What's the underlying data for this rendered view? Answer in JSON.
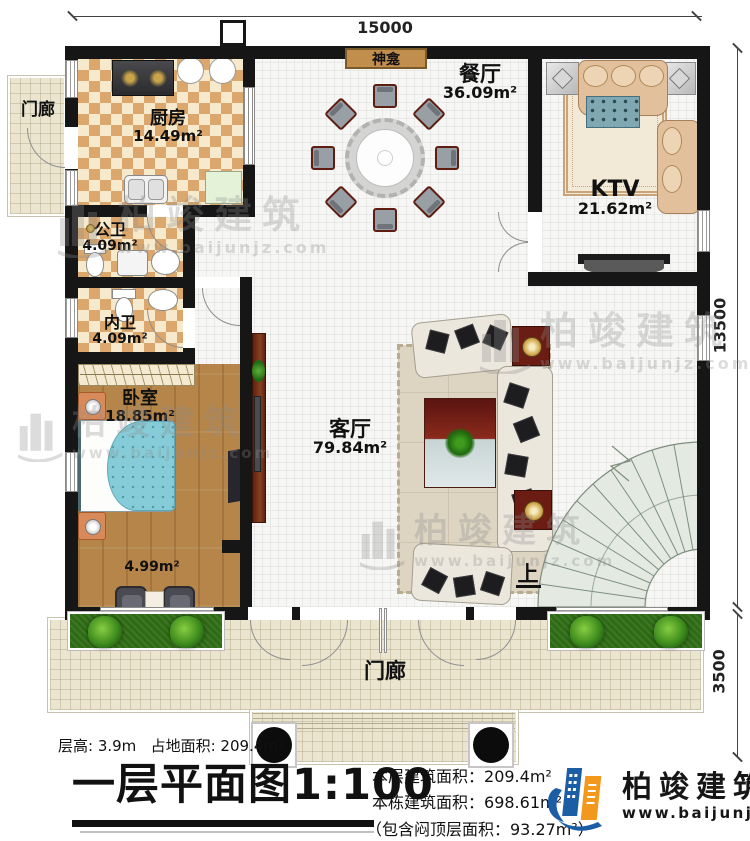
{
  "dim": {
    "top": "15000",
    "right": "13500",
    "bottom_right": "3500"
  },
  "rooms": {
    "porch_top": {
      "name": "门廊"
    },
    "kitchen": {
      "name": "厨房",
      "area": "14.49m²"
    },
    "public_bath": {
      "name": "公卫",
      "area": "4.09m²"
    },
    "private_bath": {
      "name": "内卫",
      "area": "4.09m²"
    },
    "bedroom": {
      "name": "卧室",
      "area": "18.85m²"
    },
    "alcove": {
      "area": "4.99m²"
    },
    "living": {
      "name": "客厅",
      "area": "79.84m²"
    },
    "dining": {
      "name": "餐厅",
      "area": "36.09m²"
    },
    "ktv": {
      "name": "KTV",
      "area": "21.62m²"
    },
    "shrine": {
      "name": "神龛"
    },
    "porch_bottom": {
      "name": "门廊"
    },
    "stairs": {
      "up_label": "上"
    }
  },
  "titleblock": {
    "floor_height": "层高: 3.9m",
    "land_area": "占地面积: 209.4m²",
    "plan_title": "一层平面图",
    "plan_scale": "1:100",
    "floor_area_label": "本层建筑面积：",
    "floor_area_value": "209.4m²",
    "building_area_label": "本栋建筑面积：",
    "building_area_value": "698.61m²",
    "attic_note": "（包含闷顶层面积：93.27m²）"
  },
  "branding": {
    "company": "柏竣建筑",
    "website": "www.baijunjz.com"
  },
  "watermark": {
    "company": "柏竣建筑",
    "website": "www.baijunjz.com"
  },
  "colors": {
    "accent_blue": "#1b5ea6",
    "accent_orange": "#f2981d",
    "shrine_fill": "#c28e4e"
  }
}
